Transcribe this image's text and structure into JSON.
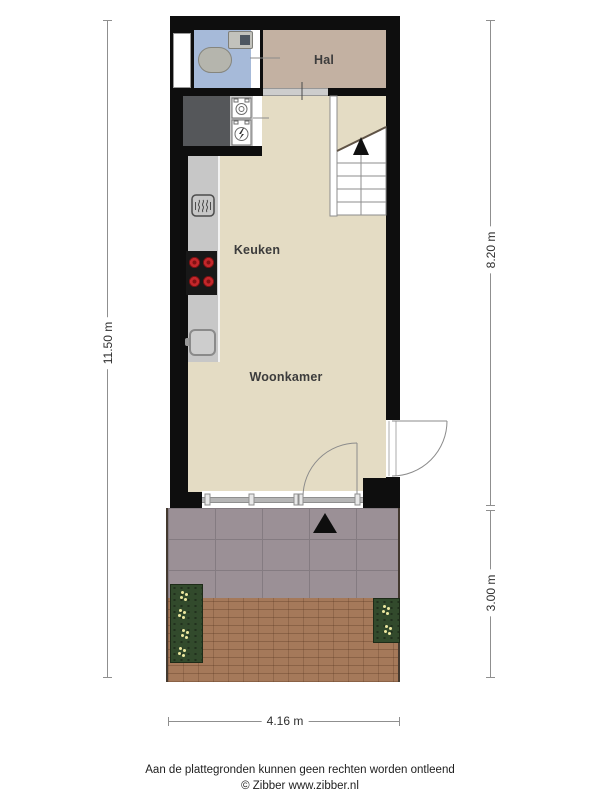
{
  "rooms": {
    "hal": "Hal",
    "keuken": "Keuken",
    "woonkamer": "Woonkamer"
  },
  "dimensions": {
    "left_total": "11.50 m",
    "right_upper": "8.20 m",
    "right_lower": "3.00 m",
    "bottom_width": "4.16 m"
  },
  "footer": {
    "disclaimer": "Aan de plattegronden kunnen geen rechten worden ontleend",
    "credit": "© Zibber www.zibber.nl"
  },
  "colors": {
    "wall": "#0e0e0e",
    "floor": "#e4dcc4",
    "hal": "#c3b1a2",
    "bath": "#a6bad9",
    "storage": "#55575a",
    "counter": "#c7c7c7",
    "cooktop": "#181818",
    "burner": "#c3272b",
    "burner_dark": "#801113",
    "terrace": "#9b9096",
    "terrace_line": "#847b81",
    "paving": "#a5795a",
    "planter": "#324a2c",
    "flower": "#ece8a0",
    "dim": "#8f8f8f"
  },
  "icons": {
    "oven": "oven-steam-icon",
    "cooktop": "cooktop-4-burners-icon",
    "kitchen_sink": "sink-icon",
    "toilet": "toilet-icon",
    "bath_sink": "washbasin-icon",
    "washer": "washing-machine-icon",
    "dryer": "dryer-lightning-icon",
    "stairs": "stairs-up-arrow-icon",
    "entrance": "entrance-arrow-icon"
  }
}
